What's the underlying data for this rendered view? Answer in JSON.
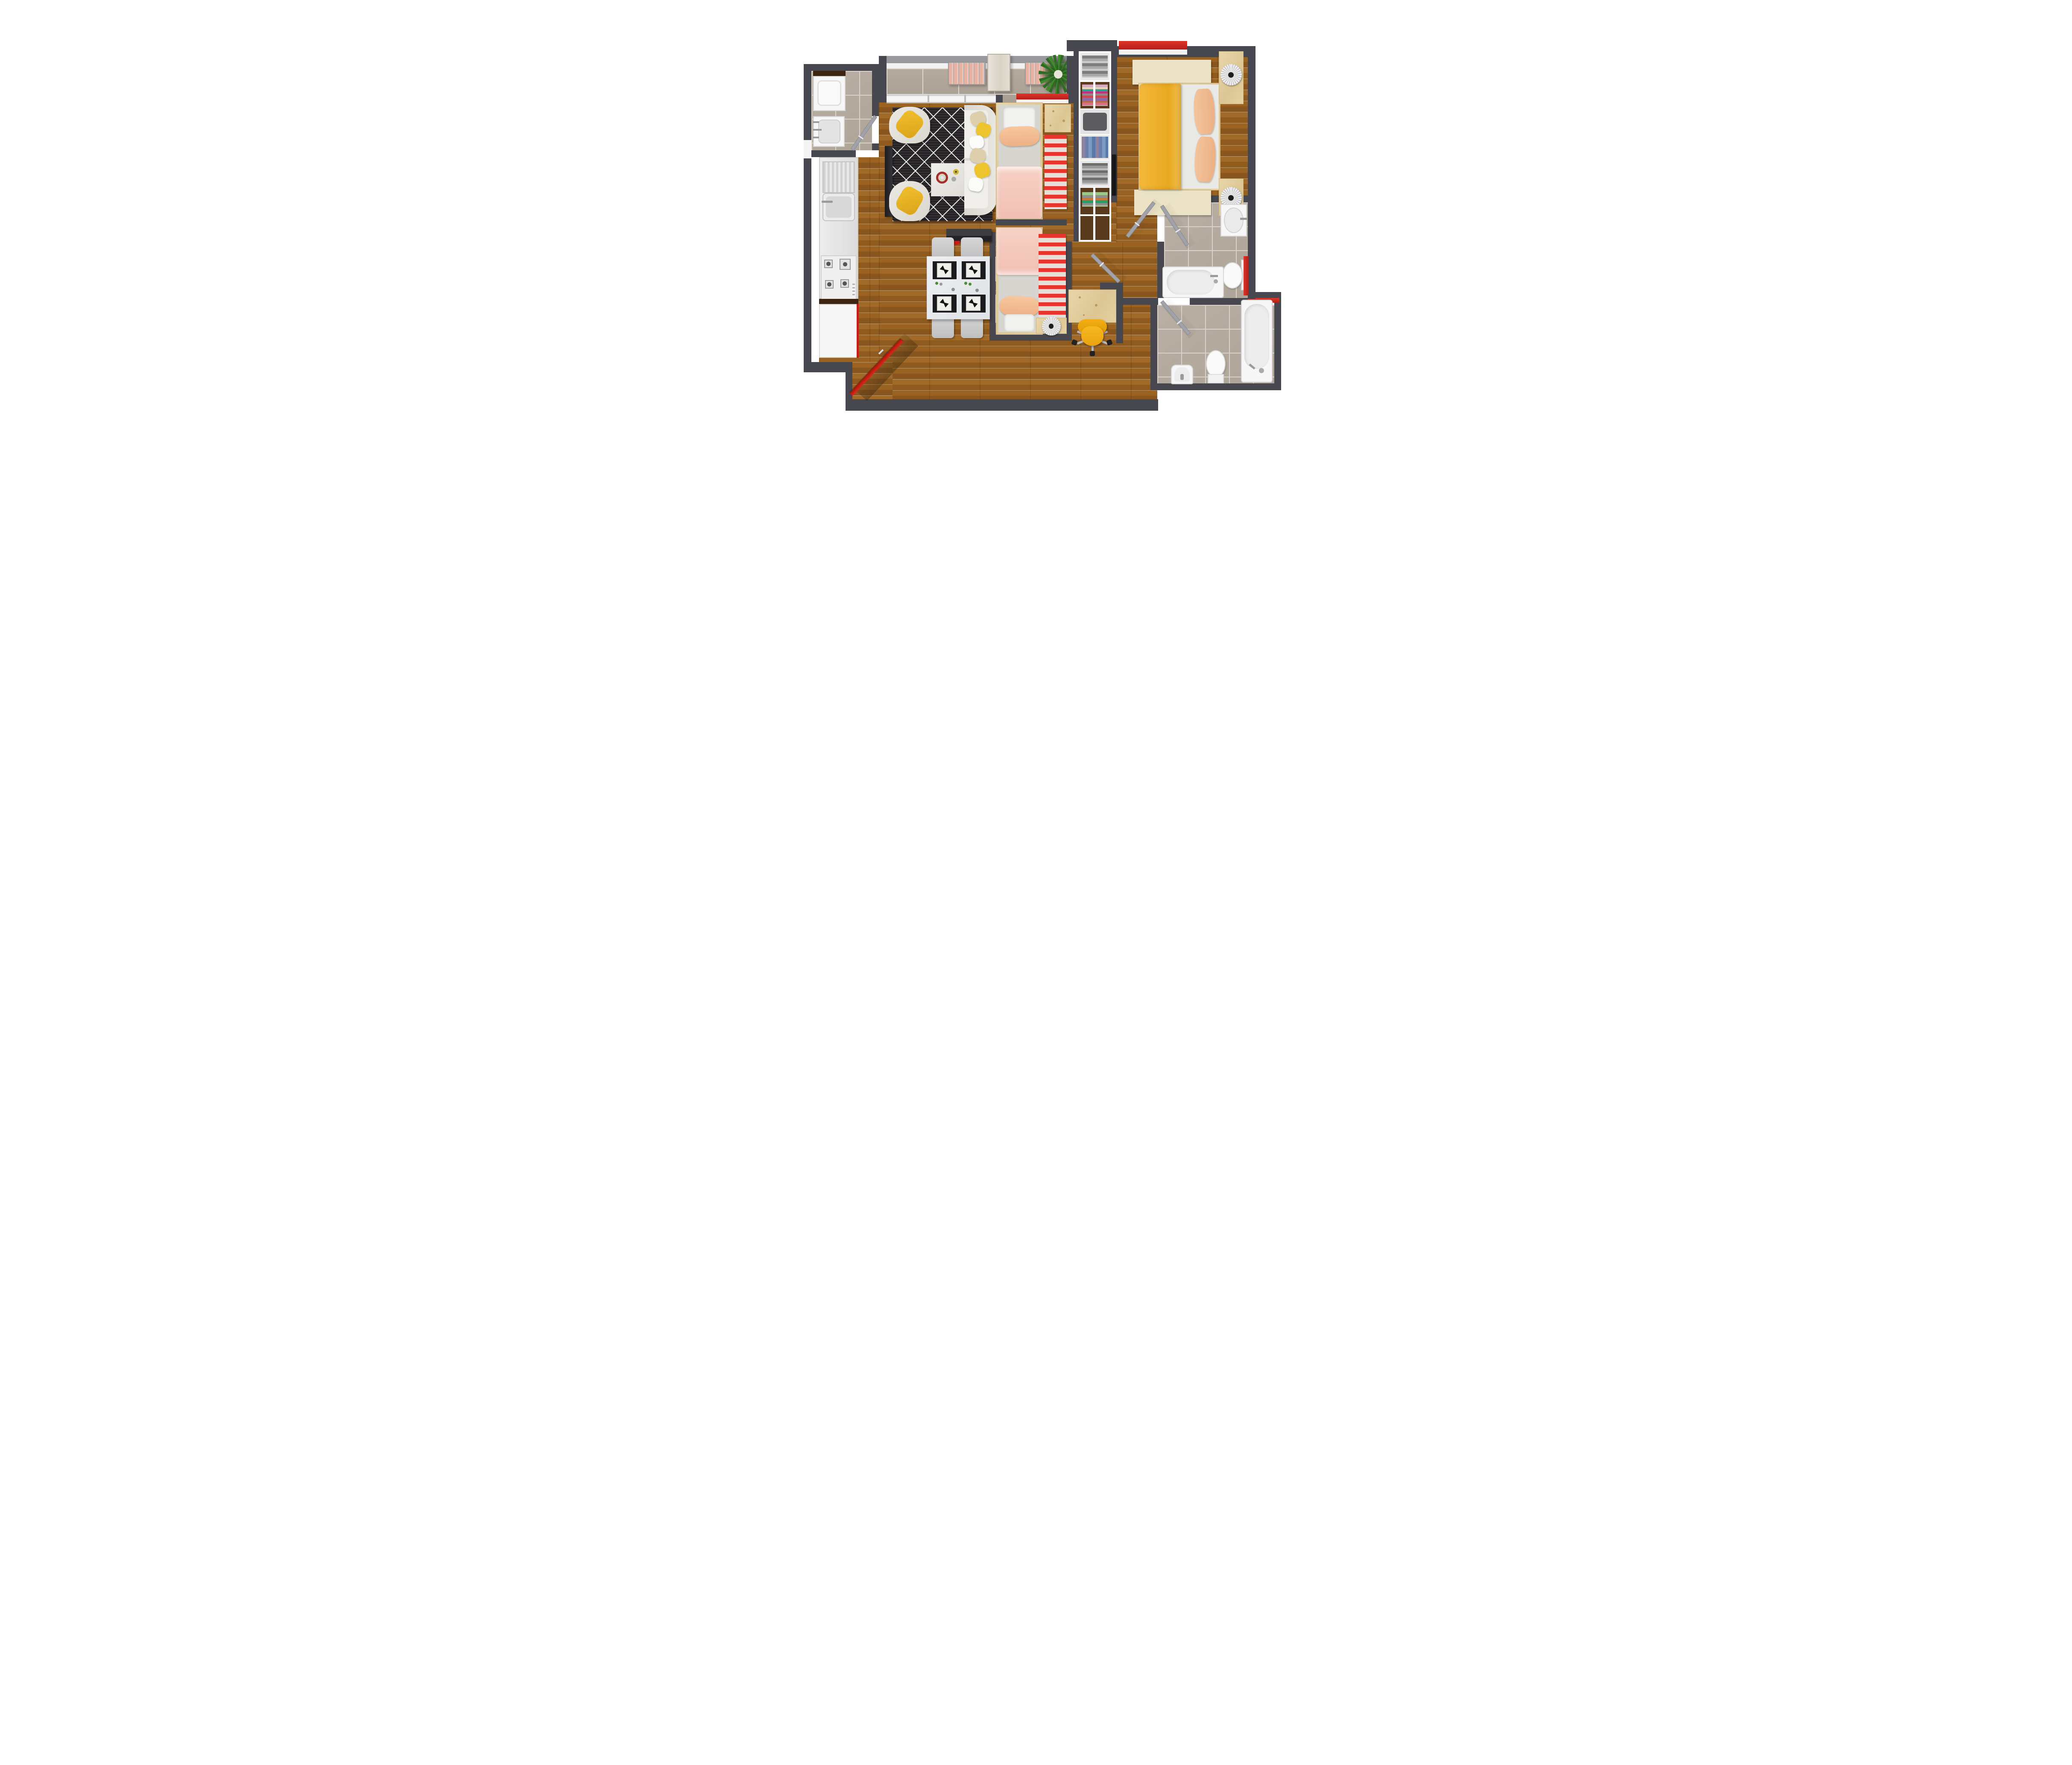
{
  "meta": {
    "title": "Two-bedroom apartment floor plan, top-down 3D render"
  },
  "palette": {
    "wall": "#47474f",
    "wood_floor": "#96601f",
    "tile_floor": "#b3a89e",
    "accent_red": "#d9261c",
    "accent_yellow": "#f0b42a",
    "peach": "#f4c39c",
    "pink": "#f6cfc2",
    "cream_rug": "#ece3c6",
    "light_wood": "#e3cfa0",
    "white_fixture": "#f7f7f7"
  },
  "rooms": [
    {
      "name": "Balcony",
      "furniture": [
        "folding slat chair",
        "side table",
        "folding slat chair",
        "potted plant",
        "railing"
      ]
    },
    {
      "name": "Laundry room",
      "furniture": [
        "washing machine",
        "laundry sink",
        "door"
      ]
    },
    {
      "name": "Kitchen",
      "furniture": [
        "sink with drainboard",
        "4-burner cooktop",
        "base cabinet with red edge"
      ]
    },
    {
      "name": "Living room",
      "furniture": [
        "diamond pattern rug",
        "sofa with cushions",
        "armchair with yellow cushion",
        "armchair with yellow cushion",
        "coffee table with clock",
        "tv console"
      ]
    },
    {
      "name": "Dining area",
      "furniture": [
        "dining table",
        "4 chairs",
        "4 place settings"
      ]
    },
    {
      "name": "Bedroom alcove 1",
      "furniture": [
        "single bed",
        "striped runner rug",
        "wooden chest",
        "red window bench"
      ]
    },
    {
      "name": "Bedroom alcove 2",
      "furniture": [
        "single bed",
        "striped runner rug",
        "nightstand with pleated lamp",
        "sideboard"
      ]
    },
    {
      "name": "Study nook",
      "furniture": [
        "desk",
        "yellow swivel chair"
      ]
    },
    {
      "name": "Wardrobe closet",
      "furniture": [
        "folded gray clothes",
        "folded colorful clothes",
        "gray shirt",
        "rolled jeans",
        "folded gray stack",
        "folded green stack",
        "wall tv"
      ]
    },
    {
      "name": "Master bedroom",
      "furniture": [
        "double bed with yellow blanket",
        "peach pillows",
        "cream rug",
        "cream rug",
        "nightstand with pleated lamp",
        "nightstand with pleated lamp",
        "red window bench"
      ]
    },
    {
      "name": "Bathroom 1",
      "furniture": [
        "vanity sink",
        "toilet",
        "red towel",
        "bathtub",
        "door"
      ]
    },
    {
      "name": "Bathroom 2",
      "furniture": [
        "bidet",
        "toilet",
        "bathtub",
        "red towel rail",
        "door"
      ]
    },
    {
      "name": "Entry",
      "furniture": [
        "red entry door"
      ]
    }
  ]
}
